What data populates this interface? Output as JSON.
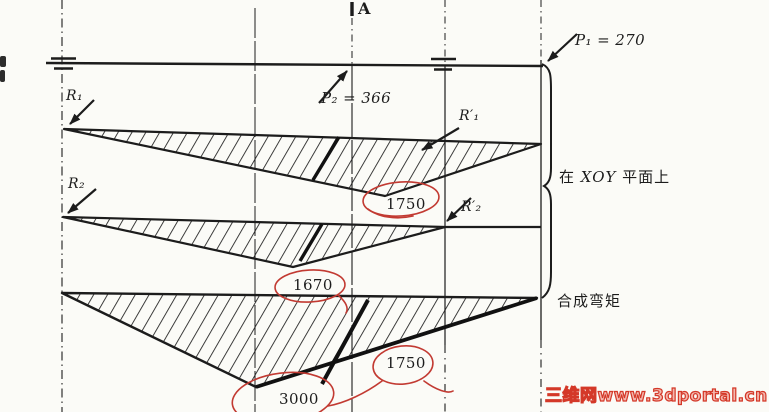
{
  "page": {
    "paper_color": "#fbfbf7",
    "ink_color": "#1c1c1c",
    "red_pen_color": "#c23a32",
    "watermark_red": "#d43828"
  },
  "labels": {
    "point_a": "A",
    "force_p1": "P₁ = 270",
    "force_p2": "P₂ = 366",
    "reaction_r1": "R₁",
    "reaction_r2": "R₂",
    "reaction_r1_prime": "R′₁",
    "reaction_r2_prime": "R′₂"
  },
  "moment_values": {
    "diagram1_peak": "1750",
    "diagram2_peak": "1670",
    "diagram3_peak_left": "3000",
    "diagram3_peak_right": "1750"
  },
  "annotations": {
    "plane_prefix": "在",
    "plane_axes": " XOY ",
    "plane_suffix": "平面上",
    "resultant_note": "合成弯矩"
  },
  "watermark": "三维网www.3dportal.cn"
}
